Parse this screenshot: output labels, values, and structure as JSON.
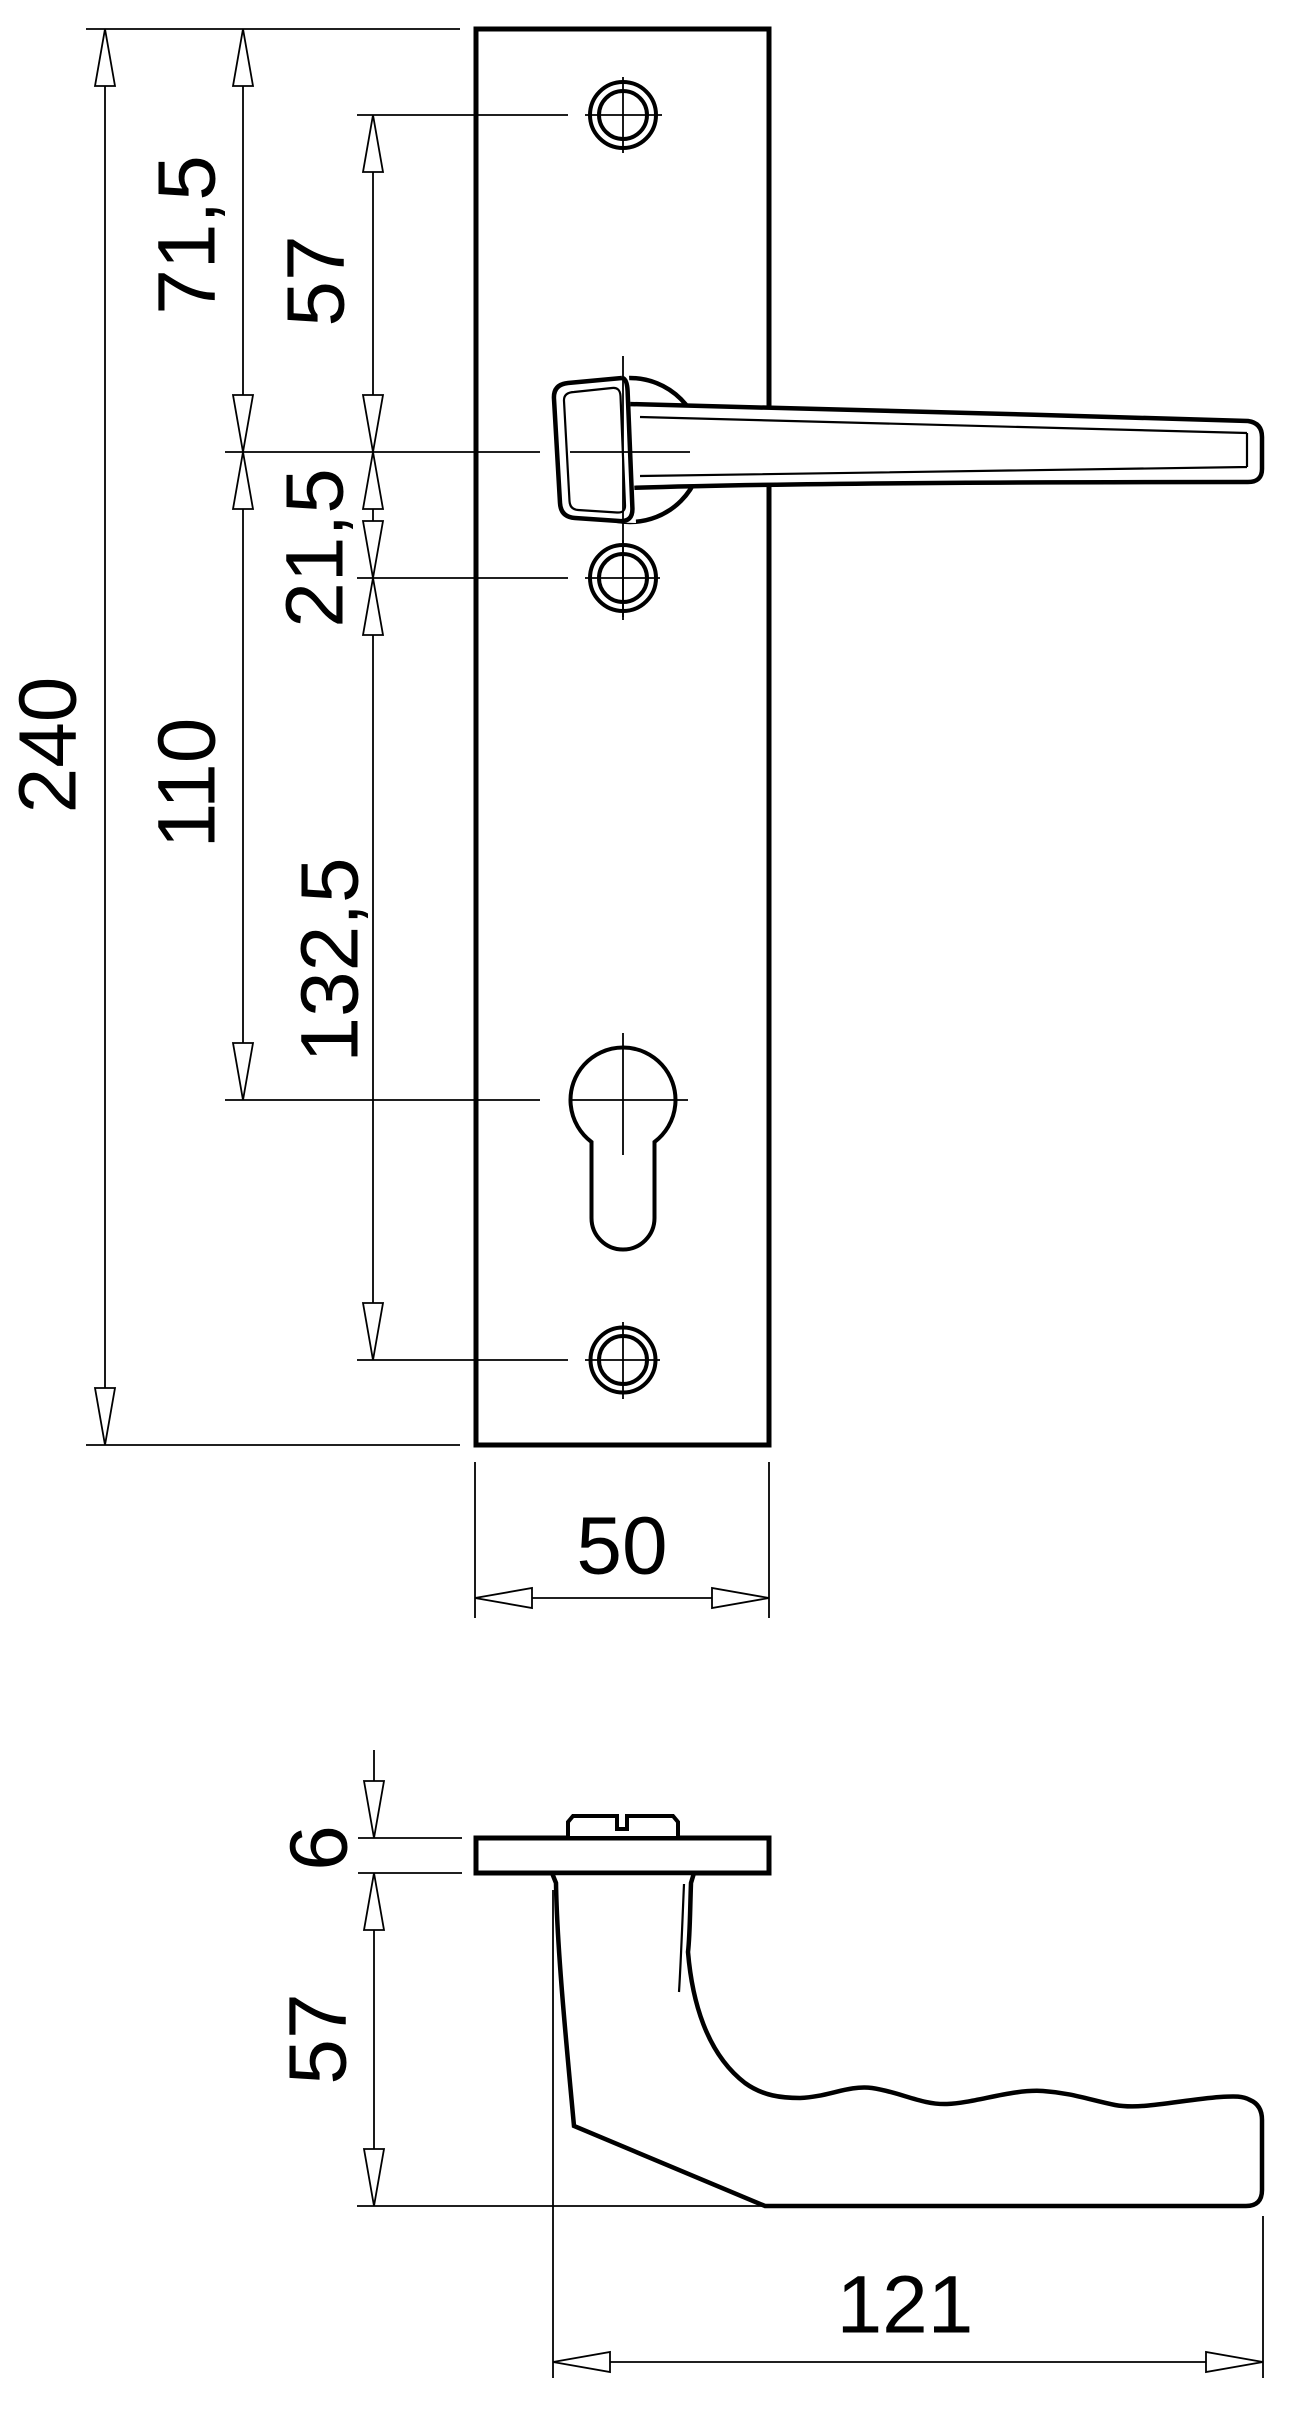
{
  "drawing": {
    "type": "technical dimensional drawing of a door handle with long backplate",
    "colors": {
      "line": "#000000",
      "background": "#ffffff"
    },
    "front_view": {
      "dimensions": {
        "total_height": "240",
        "plate_top_to_handle_axis": "71,5",
        "top_screw_to_handle_axis": "57",
        "handle_axis_to_lower_screw": "21,5",
        "handle_axis_to_cylinder": "110",
        "lower_screw_to_bottom_screw": "132,5",
        "plate_width": "50"
      }
    },
    "side_view": {
      "dimensions": {
        "plate_thickness": "6",
        "handle_projection": "57",
        "handle_length": "121"
      }
    }
  }
}
